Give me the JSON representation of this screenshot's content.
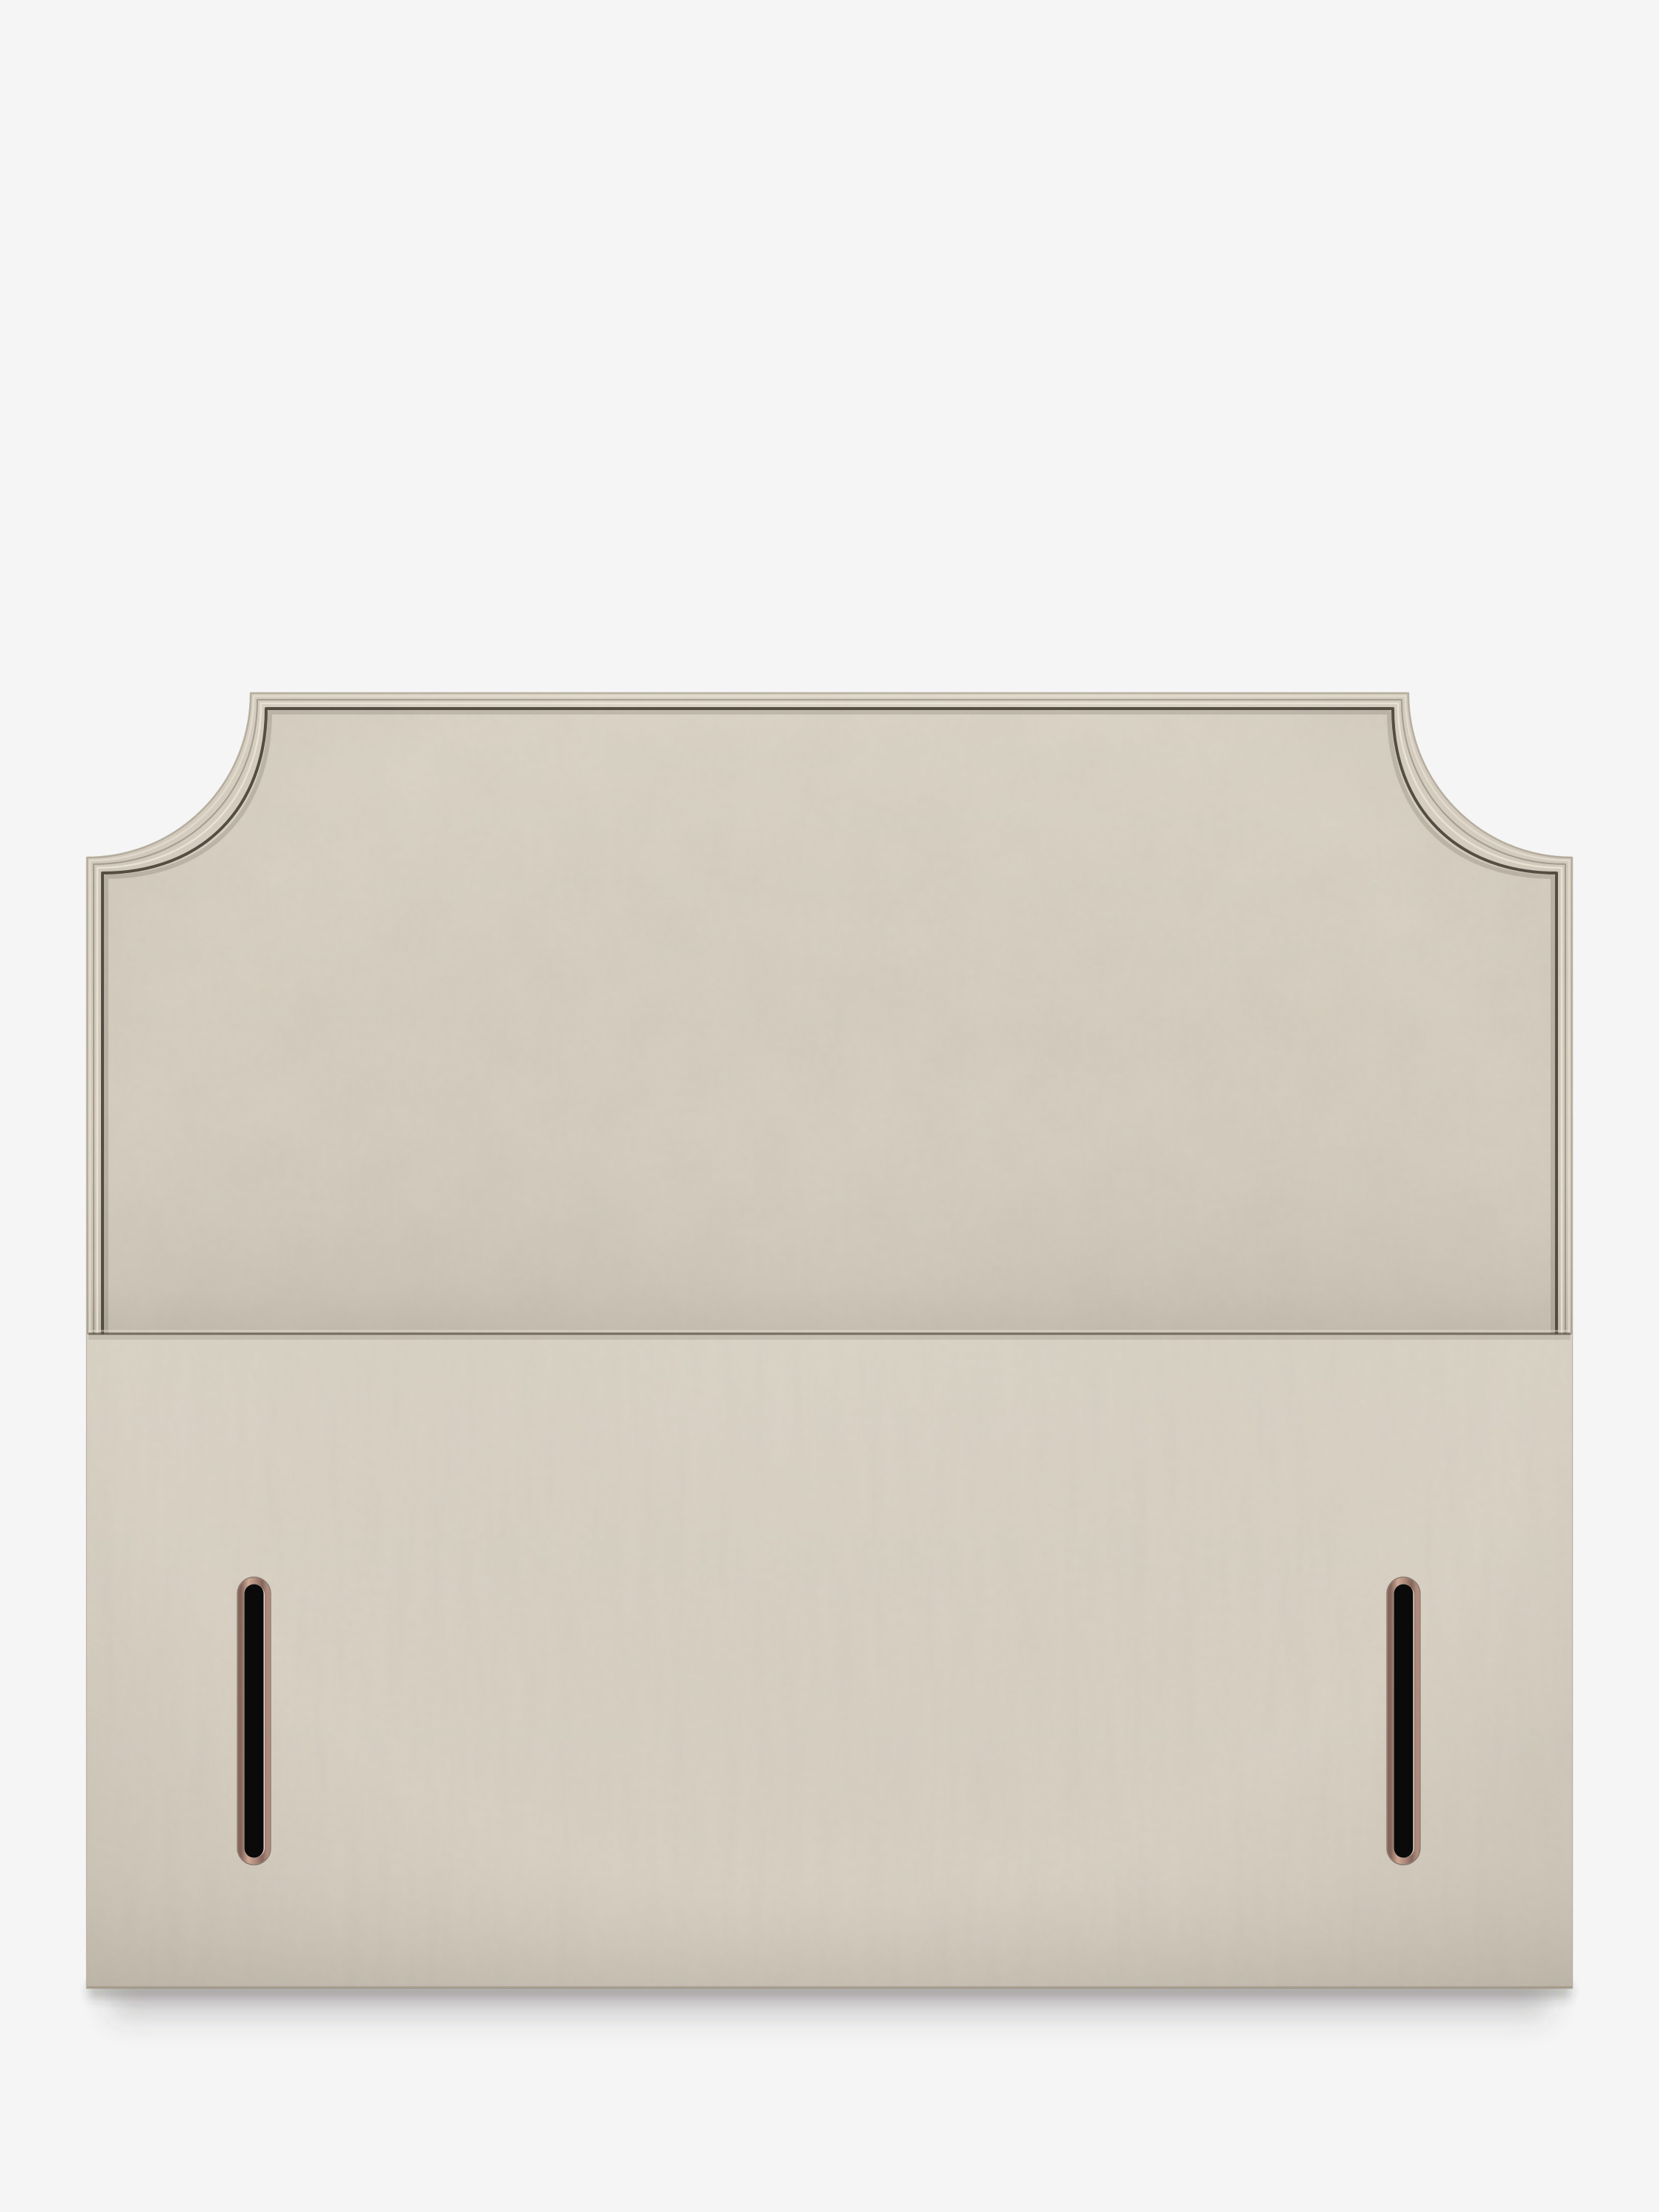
{
  "scene": {
    "description": "Product photograph of a natural beige upholstered divan headboard with a flat top edge, scooped cut-away top corners finished with piped trim, a horizontal seam across the middle, and two vertical strut slots with copper-pink metal trim and dark interiors near the base."
  },
  "colors": {
    "background": "#f5f5f6",
    "fabric_base": "#d4cdbe",
    "fabric_base_lower": "#d6cfc1",
    "fabric_noise_tone": "#8b8070",
    "edge_outline": "#968b77",
    "piping_highlight_1": "#e8e1d2",
    "piping_groove": "#6e6454",
    "piping_highlight_2": "#f0eadb",
    "piping_shadow": "#473f33",
    "piping_inner_soft": "#4a4236",
    "seam_highlight": "#e4ddcf",
    "seam_line": "#5f5749",
    "seam_soft_shadow": "#5a5244",
    "slot_copper_light": "#cfa795",
    "slot_copper_mid": "#ae8a7c",
    "slot_copper_dark": "#83655a",
    "slot_outline": "#6e564c",
    "slot_interior": "#0b0a0b",
    "slot_highlight": "#e3ddd4",
    "drop_shadow": "#3c3832",
    "vignette_tone": "#4f463a",
    "sheen_tone": "#fffdf4"
  },
  "product": {
    "slot_count": 2,
    "panel_count": 2
  }
}
